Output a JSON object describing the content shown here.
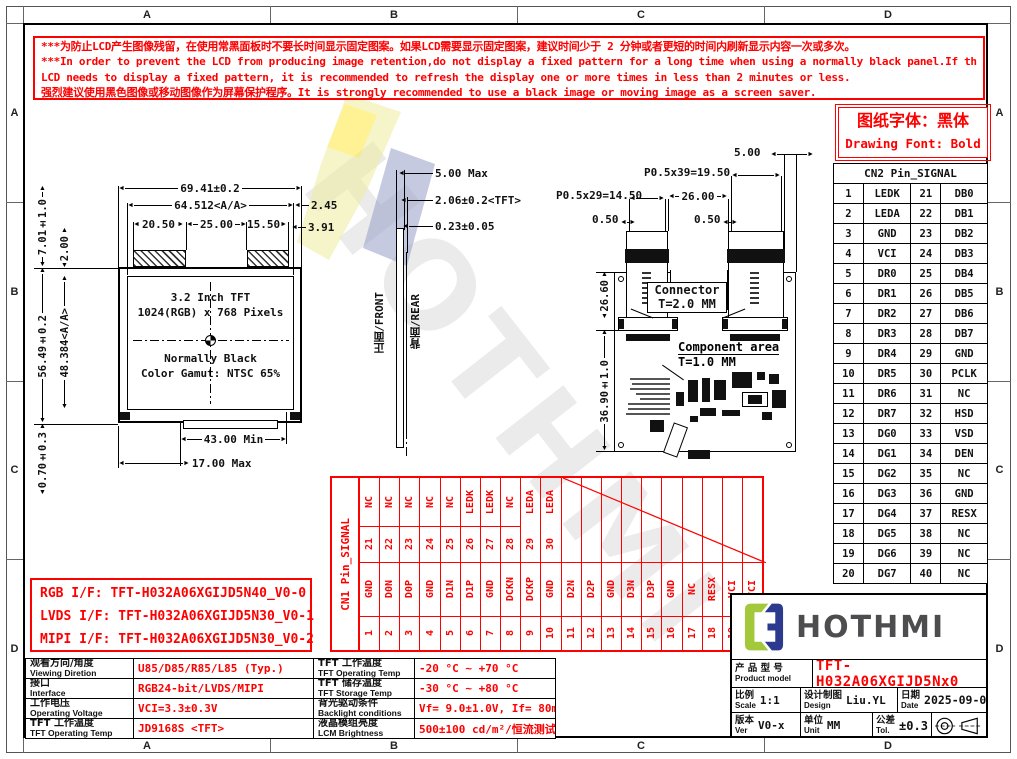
{
  "colors": {
    "red": "#fe0000",
    "logo_green": "#a3c93a",
    "logo_navy": "#2b3a8f",
    "brand_text": "#4d4d4f"
  },
  "frame": {
    "h": [
      "A",
      "B",
      "C",
      "D"
    ],
    "v": [
      "A",
      "B",
      "C",
      "D"
    ]
  },
  "warning": {
    "lines": [
      "***为防止LCD产生图像残留，在使用常黑面板时不要长时间显示固定图案。如果LCD需要显示固定图案，建议时间少于 2 分钟或者更短的时间内刷新显示内容一次或多次。",
      "***In order to prevent the LCD from producing image retention,do not display a fixed pattern for a long time when using a normally black panel.If the",
      " LCD needs to display a fixed pattern, it is recommended to refresh the display one or more times in less than 2 minutes or less.",
      "强烈建议使用黑色图像或移动图像作为屏幕保护程序。It is strongly recommended to use a black image or moving image as a screen saver."
    ]
  },
  "font_note": {
    "cn": "图纸字体：黑体",
    "en": "Drawing Font: Bold"
  },
  "cn2": {
    "title": "CN2 Pin_SIGNAL",
    "rows": [
      [
        "1",
        "LEDK",
        "21",
        "DB0"
      ],
      [
        "2",
        "LEDA",
        "22",
        "DB1"
      ],
      [
        "3",
        "GND",
        "23",
        "DB2"
      ],
      [
        "4",
        "VCI",
        "24",
        "DB3"
      ],
      [
        "5",
        "DR0",
        "25",
        "DB4"
      ],
      [
        "6",
        "DR1",
        "26",
        "DB5"
      ],
      [
        "7",
        "DR2",
        "27",
        "DB6"
      ],
      [
        "8",
        "DR3",
        "28",
        "DB7"
      ],
      [
        "9",
        "DR4",
        "29",
        "GND"
      ],
      [
        "10",
        "DR5",
        "30",
        "PCLK"
      ],
      [
        "11",
        "DR6",
        "31",
        "NC"
      ],
      [
        "12",
        "DR7",
        "32",
        "HSD"
      ],
      [
        "13",
        "DG0",
        "33",
        "VSD"
      ],
      [
        "14",
        "DG1",
        "34",
        "DEN"
      ],
      [
        "15",
        "DG2",
        "35",
        "NC"
      ],
      [
        "16",
        "DG3",
        "36",
        "GND"
      ],
      [
        "17",
        "DG4",
        "37",
        "RESX"
      ],
      [
        "18",
        "DG5",
        "38",
        "NC"
      ],
      [
        "19",
        "DG6",
        "39",
        "NC"
      ],
      [
        "20",
        "DG7",
        "40",
        "NC"
      ]
    ]
  },
  "cn1": {
    "title": "CN1 Pin_SIGNAL",
    "cols": [
      {
        "p1": "1",
        "s1": "GND",
        "p2": "21",
        "s2": "NC"
      },
      {
        "p1": "2",
        "s1": "D0N",
        "p2": "22",
        "s2": "NC"
      },
      {
        "p1": "3",
        "s1": "D0P",
        "p2": "23",
        "s2": "NC"
      },
      {
        "p1": "4",
        "s1": "GND",
        "p2": "24",
        "s2": "NC"
      },
      {
        "p1": "5",
        "s1": "D1N",
        "p2": "25",
        "s2": "NC"
      },
      {
        "p1": "6",
        "s1": "D1P",
        "p2": "26",
        "s2": "LEDK"
      },
      {
        "p1": "7",
        "s1": "GND",
        "p2": "27",
        "s2": "LEDK"
      },
      {
        "p1": "8",
        "s1": "DCKN",
        "p2": "28",
        "s2": "NC"
      },
      {
        "p1": "9",
        "s1": "DCKP",
        "p2": "29",
        "s2": "LEDA"
      },
      {
        "p1": "10",
        "s1": "GND",
        "p2": "30",
        "s2": "LEDA"
      },
      {
        "p1": "11",
        "s1": "D2N",
        "p2": "",
        "s2": ""
      },
      {
        "p1": "12",
        "s1": "D2P",
        "p2": "",
        "s2": ""
      },
      {
        "p1": "13",
        "s1": "GND",
        "p2": "",
        "s2": ""
      },
      {
        "p1": "14",
        "s1": "D3N",
        "p2": "",
        "s2": ""
      },
      {
        "p1": "15",
        "s1": "D3P",
        "p2": "",
        "s2": ""
      },
      {
        "p1": "16",
        "s1": "GND",
        "p2": "",
        "s2": ""
      },
      {
        "p1": "17",
        "s1": "NC",
        "p2": "",
        "s2": ""
      },
      {
        "p1": "18",
        "s1": "RESX",
        "p2": "",
        "s2": ""
      },
      {
        "p1": "19",
        "s1": "VCI",
        "p2": "",
        "s2": ""
      },
      {
        "p1": "20",
        "s1": "VCI",
        "p2": "",
        "s2": ""
      }
    ]
  },
  "front_view": {
    "dim_width_total": "69.41±0.2",
    "dim_width_aa": "64.512<A/A>",
    "dim_seg1": "20.50",
    "dim_seg2": "25.00",
    "dim_seg3": "15.50",
    "dim_right_top": "2.45",
    "dim_right_bottom": "3.91",
    "dim_h_top": "7.01±1.0",
    "dim_h_step": "2.00",
    "dim_h_total": "56.49±0.2",
    "dim_h_aa": "48.384<A/A>",
    "dim_h_bottom": "0.70±0.3",
    "dim_bottom_min": "43.00 Min",
    "dim_bottom_max": "17.00 Max",
    "display_lines": [
      "3.2 Inch TFT",
      "1024(RGB) x 768 Pixels",
      "Normally Black",
      "Color Gamut: NTSC 65%"
    ]
  },
  "side_view": {
    "dim1": "5.00 Max",
    "dim2": "2.06±0.2<TFT>",
    "dim3": "0.23±0.05",
    "label_front": "正面/FRONT",
    "label_rear": "背面/REAR"
  },
  "rear_view": {
    "dim_top": "5.00",
    "dim_p39": "P0.5x39=19.50",
    "dim_p29": "P0.5x29=14.50",
    "dim_26": "26.00",
    "dim_05l": "0.50",
    "dim_05r": "0.50",
    "dim_h1": "26.60",
    "dim_h2": "36.90±1.0",
    "connector_label": "Connector",
    "connector_t": "T=2.0 MM",
    "component_label": "Component area",
    "component_t": "T=1.0 MM"
  },
  "interfaces": {
    "lines": [
      "RGB I/F: TFT-H032A06XGIJD5N40_V0-0",
      "LVDS I/F: TFT-H032A06XGIJD5N30_V0-1",
      "MIPI I/F: TFT-H032A06XGIJD5N30_V0-2"
    ]
  },
  "specs": {
    "rows": [
      {
        "c1": "观看方向/角度",
        "e1": "Viewing Diretion",
        "v1": "U85/D85/R85/L85 (Typ.)",
        "c2": "TFT 工作温度",
        "e2": "TFT Operating Temp",
        "v2": "-20 °C ~ +70 °C"
      },
      {
        "c1": "接口",
        "e1": "Interface",
        "v1": "RGB24-bit/LVDS/MIPI",
        "c2": "TFT 储存温度",
        "e2": "TFT Storage Temp",
        "v2": "-30 °C ~ +80 °C"
      },
      {
        "c1": "工作电压",
        "e1": "Operating Voltage",
        "v1": "VCI=3.3±0.3V",
        "c2": "背光驱动条件",
        "e2": "Backlight conditions",
        "v2": "Vf= 9.0±1.0V, If= 80mA"
      },
      {
        "c1": "TFT 工作温度",
        "e1": "TFT Operating Temp",
        "v1": "JD9168S <TFT>",
        "c2": "液晶模组亮度",
        "e2": "LCM Brightness",
        "v2": "500±100 cd/m²/恒流测试"
      }
    ]
  },
  "title_block": {
    "brand": "HOTHMI",
    "product_label_cn": "产 品 型 号",
    "product_label_en": "Product model",
    "product_model": "TFT-H032A06XGIJD5Nx0",
    "scale_cn": "比例",
    "scale_en": "Scale",
    "scale_value": "1:1",
    "design_cn": "设计制图",
    "design_en": "Design",
    "design_value": "Liu.YL",
    "date_cn": "日期",
    "date_en": "Date",
    "date_value": "2025-09-05",
    "ver_cn": "版本",
    "ver_en": "Ver",
    "ver_value": "V0-x",
    "unit_cn": "单位",
    "unit_en": "Unit",
    "unit_value": "MM",
    "tol_cn": "公差",
    "tol_en": "Tol.",
    "tol_value": "±0.3"
  },
  "watermark": {
    "text": "HOTHMI"
  }
}
